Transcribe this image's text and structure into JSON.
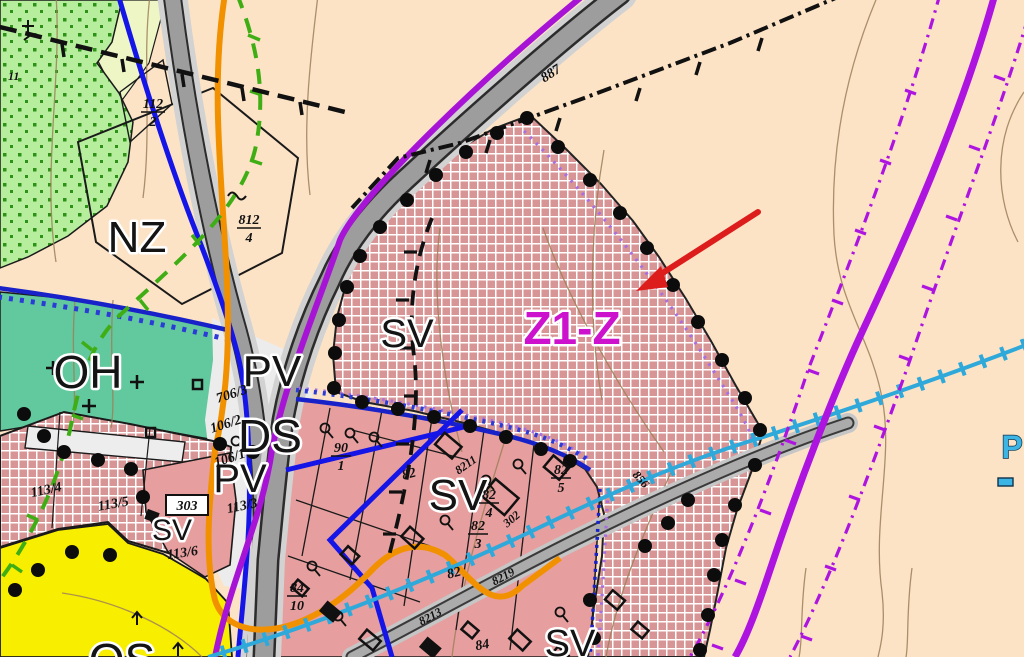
{
  "map": {
    "zone_labels": {
      "nz": "NZ",
      "oh": "OH",
      "pv_upper": "PV",
      "ds": "DS",
      "pv_lower": "PV",
      "sv_upper": "SV",
      "z1_z": "Z1-Z",
      "sv_central": "SV",
      "sv_left": "SV",
      "sv_bottom": "SV",
      "os": "OS",
      "p_edge": "P"
    },
    "road_labels": {
      "road_887": "887",
      "road_856": "856"
    },
    "utility_labels": {
      "l8211": "8211",
      "l8219": "8219",
      "l8213": "8213"
    },
    "parcel_labels": {
      "p11": "11",
      "p112_2": {
        "num": "112",
        "den": "2"
      },
      "p812_4": {
        "num": "812",
        "den": "4"
      },
      "p706_3": "706/3",
      "p106_2": "106/2",
      "p106_1": "106/1",
      "p113_4": "113/4",
      "p113_5": "113/5",
      "p113_3": "113/3",
      "p113_6": "113/6",
      "p303": "303",
      "p90_1": {
        "num": "90",
        "den": "1"
      },
      "p82": "82",
      "p82_b": "82",
      "p84": "84",
      "p82_4": {
        "num": "82",
        "den": "4"
      },
      "p82_3": {
        "num": "82",
        "den": "3"
      },
      "p82_5": {
        "num": "82",
        "den": "5"
      },
      "p84_10": {
        "num": "84",
        "den": "10"
      },
      "p302": "302"
    },
    "colors": {
      "background": "#fce3c6",
      "zone_mixed_rural_hatch": "#d89595",
      "zone_mixed_rural_plain": "#e79e9e",
      "zone_cemetery_teal": "#62c89e",
      "zone_sport_yellow": "#f8ee00",
      "zone_nature_green": "#b6ee9d",
      "change_area_label_magenta": "#cc12cc",
      "arrow_red": "#dd1c1c",
      "water_utility_cyan": "#2fa8da",
      "corridor_purple": "#a714d6",
      "utility_orange": "#f29100",
      "utility_blue": "#1515e8",
      "boundary_green": "#3fae14",
      "road_gray": "#9d9d9d"
    }
  }
}
